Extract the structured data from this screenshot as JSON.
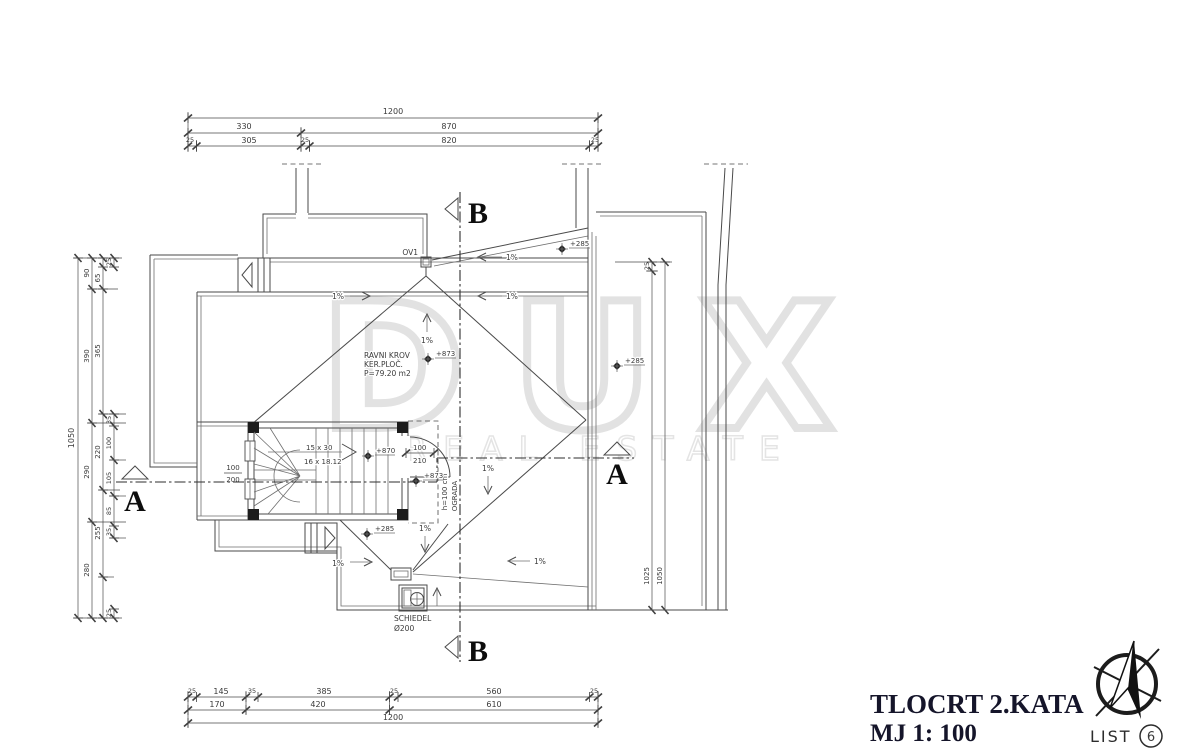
{
  "drawing": {
    "background": "#ffffff",
    "line_color": "#4a4a4a",
    "watermark": {
      "brand": "DUX",
      "tagline": "REAL ESTATE"
    },
    "title_block": {
      "title": "TLOCRT 2.KATA",
      "scale": "MJ 1: 100",
      "sheet_label": "LIST",
      "sheet_number": "6"
    },
    "sections": {
      "a": "A",
      "b": "B"
    },
    "dims": {
      "top": {
        "row1": "1200",
        "row2": [
          "330",
          "870"
        ],
        "row3": [
          "25",
          "305",
          "25",
          "820",
          "25"
        ]
      },
      "bottom": {
        "row1": [
          "25",
          "145",
          "35",
          "385",
          "25",
          "560",
          "25"
        ],
        "row2": [
          "170",
          "420",
          "610"
        ],
        "row3": "1200"
      },
      "left": {
        "l1": "1050",
        "l2": [
          "90",
          "390",
          "290",
          "280"
        ],
        "l3": [
          "65",
          "365",
          "220",
          "255"
        ],
        "l4": [
          "25",
          "35",
          "100",
          "105",
          "85",
          "35",
          "25"
        ]
      },
      "right": {
        "r1": "25",
        "r2": "1025",
        "r3": "1050"
      }
    },
    "annotations": {
      "flat_roof": [
        "RAVNI KROV",
        "KER.PLOČ.",
        "P=79.20 m2"
      ],
      "stair_run1": "15 x 30",
      "stair_run2": "16 x 18.12",
      "chimney1": "SCHIEDEL",
      "chimney2": "Ø200",
      "drain": "OV1",
      "railing": "OGRADA",
      "railing_height": "h=100 cm",
      "window_w": "100",
      "window_h": "200",
      "door_w": "100",
      "door_h": "210",
      "slope": "1%",
      "spot_873": "+873",
      "spot_870": "+870",
      "spot_285": "+285"
    }
  }
}
